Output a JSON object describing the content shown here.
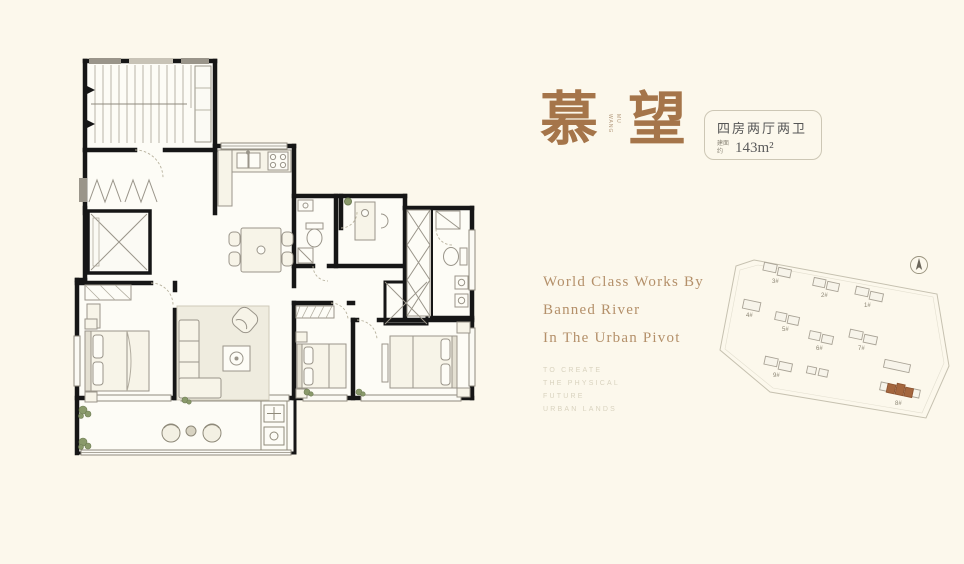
{
  "colors": {
    "background": "#FCF8EC",
    "accent": "#A5754A",
    "tagline": "#B4906A",
    "highlight_building": "#A4663E"
  },
  "title": {
    "char_left": "慕",
    "char_right": "望",
    "seal_top": "MU",
    "seal_bottom": "WANG"
  },
  "spec_box": {
    "layout_line": "四房两厅两卫",
    "area_prefix": "建面约",
    "area_value": "143m²"
  },
  "tagline": {
    "lines": [
      "World Class Works By",
      "Banned River",
      "In The Urban Pivot"
    ]
  },
  "subtext": {
    "lines": [
      "TO CREATE",
      "THE PHYSICAL",
      "FUTURE",
      "URBAN LANDS"
    ]
  },
  "site_plan": {
    "buildings": [
      {
        "label": "1#"
      },
      {
        "label": "2#"
      },
      {
        "label": "3#"
      },
      {
        "label": "4#"
      },
      {
        "label": "5#"
      },
      {
        "label": "6#"
      },
      {
        "label": "7#"
      },
      {
        "label": "8#"
      },
      {
        "label": "9#"
      }
    ],
    "highlighted": "8#"
  }
}
